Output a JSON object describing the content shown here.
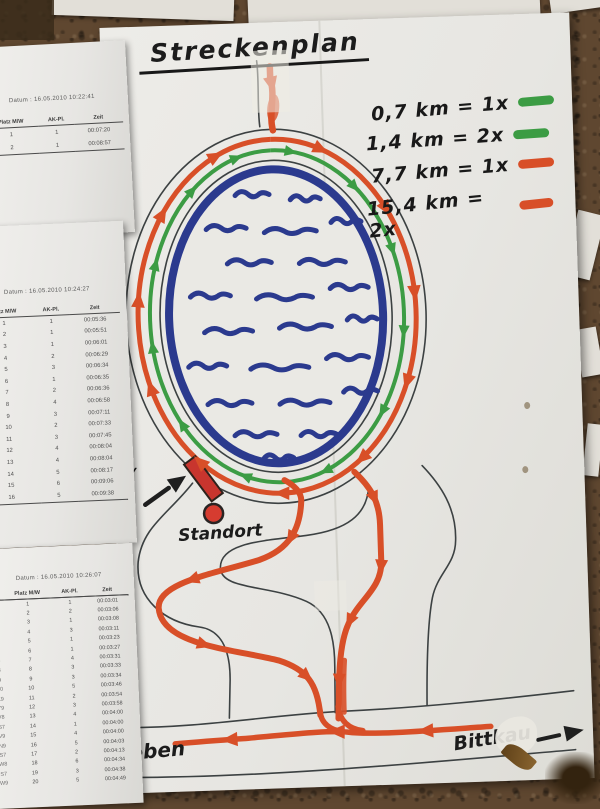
{
  "poster": {
    "title": "Streckenplan",
    "legend": [
      {
        "label": "0,7 km = 1x",
        "color": "#3c9c44"
      },
      {
        "label": "1,4 km = 2x",
        "color": "#3c9c44"
      },
      {
        "label": "7,7 km = 1x",
        "color": "#d84f28"
      },
      {
        "label": "15,4 km = 2x",
        "color": "#d84f28"
      }
    ],
    "labels": {
      "standort": "Standort",
      "start_fragment_top": "t /",
      "start_fragment_bottom": "el",
      "town_left_fragment": "eben",
      "town_right": "Bittkau"
    },
    "colors": {
      "short_route_green": "#3c9c44",
      "long_route_red": "#d84f28",
      "lake_blue": "#2b3a8e",
      "road_ink": "#3c4142",
      "marker_red": "#c8352e"
    }
  },
  "result_sheets": [
    {
      "datum_label": "Datum :",
      "datum": "16.05.2010 10:22:41",
      "columns": [
        "Platz M/W",
        "AK-Pl.",
        "Zeit"
      ],
      "rows": [
        [
          "1",
          "1",
          "00:07:20"
        ],
        [
          "2",
          "1",
          "00:08:57"
        ]
      ]
    },
    {
      "datum_label": "Datum :",
      "datum": "16.05.2010 10:24:27",
      "columns": [
        "Platz M/W",
        "AK-Pl.",
        "Zeit"
      ],
      "rows": [
        [
          "1",
          "1",
          "00:05:36"
        ],
        [
          "2",
          "1",
          "00:05:51"
        ],
        [
          "3",
          "1",
          "00:06:01"
        ],
        [
          "4",
          "2",
          "00:06:29"
        ],
        [
          "5",
          "3",
          "00:06:34"
        ],
        [
          "6",
          "1",
          "00:06:35"
        ],
        [
          "7",
          "2",
          "00:06:36"
        ],
        [
          "8",
          "4",
          "00:06:58"
        ],
        [
          "9",
          "3",
          "00:07:11"
        ],
        [
          "10",
          "2",
          "00:07:33"
        ],
        [
          "11",
          "3",
          "00:07:45"
        ],
        [
          "12",
          "4",
          "00:08:04"
        ],
        [
          "13",
          "4",
          "00:08:04"
        ],
        [
          "14",
          "5",
          "00:08:17"
        ],
        [
          "15",
          "6",
          "00:09:06"
        ],
        [
          "16",
          "5",
          "00:09:38"
        ]
      ]
    },
    {
      "datum_label": "Datum :",
      "datum": "16.05.2010 10:26:07",
      "columns": [
        "Platz M/W",
        "AK-Pl.",
        "Zeit"
      ],
      "left_fragments": [
        "0",
        "3",
        "9",
        "0",
        "9",
        "1",
        "0",
        "8",
        "9",
        "10",
        "K9",
        "Y9",
        "V8",
        "S7",
        "V9",
        "N9",
        "S7",
        "W8",
        "S7",
        "W9"
      ],
      "rows": [
        [
          "1",
          "1",
          "00:03:01"
        ],
        [
          "2",
          "2",
          "00:03:06"
        ],
        [
          "3",
          "1",
          "00:03:08"
        ],
        [
          "4",
          "3",
          "00:03:11"
        ],
        [
          "5",
          "1",
          "00:03:23"
        ],
        [
          "6",
          "1",
          "00:03:27"
        ],
        [
          "7",
          "4",
          "00:03:31"
        ],
        [
          "8",
          "3",
          "00:03:33"
        ],
        [
          "9",
          "3",
          "00:03:34"
        ],
        [
          "10",
          "5",
          "00:03:46"
        ],
        [
          "11",
          "2",
          "00:03:54"
        ],
        [
          "12",
          "3",
          "00:03:58"
        ],
        [
          "13",
          "4",
          "00:04:00"
        ],
        [
          "14",
          "1",
          "00:04:00"
        ],
        [
          "15",
          "4",
          "00:04:00"
        ],
        [
          "16",
          "5",
          "00:04:03"
        ],
        [
          "17",
          "2",
          "00:04:13"
        ],
        [
          "18",
          "6",
          "00:04:34"
        ],
        [
          "19",
          "3",
          "00:04:38"
        ],
        [
          "20",
          "5",
          "00:04:49"
        ]
      ]
    }
  ]
}
